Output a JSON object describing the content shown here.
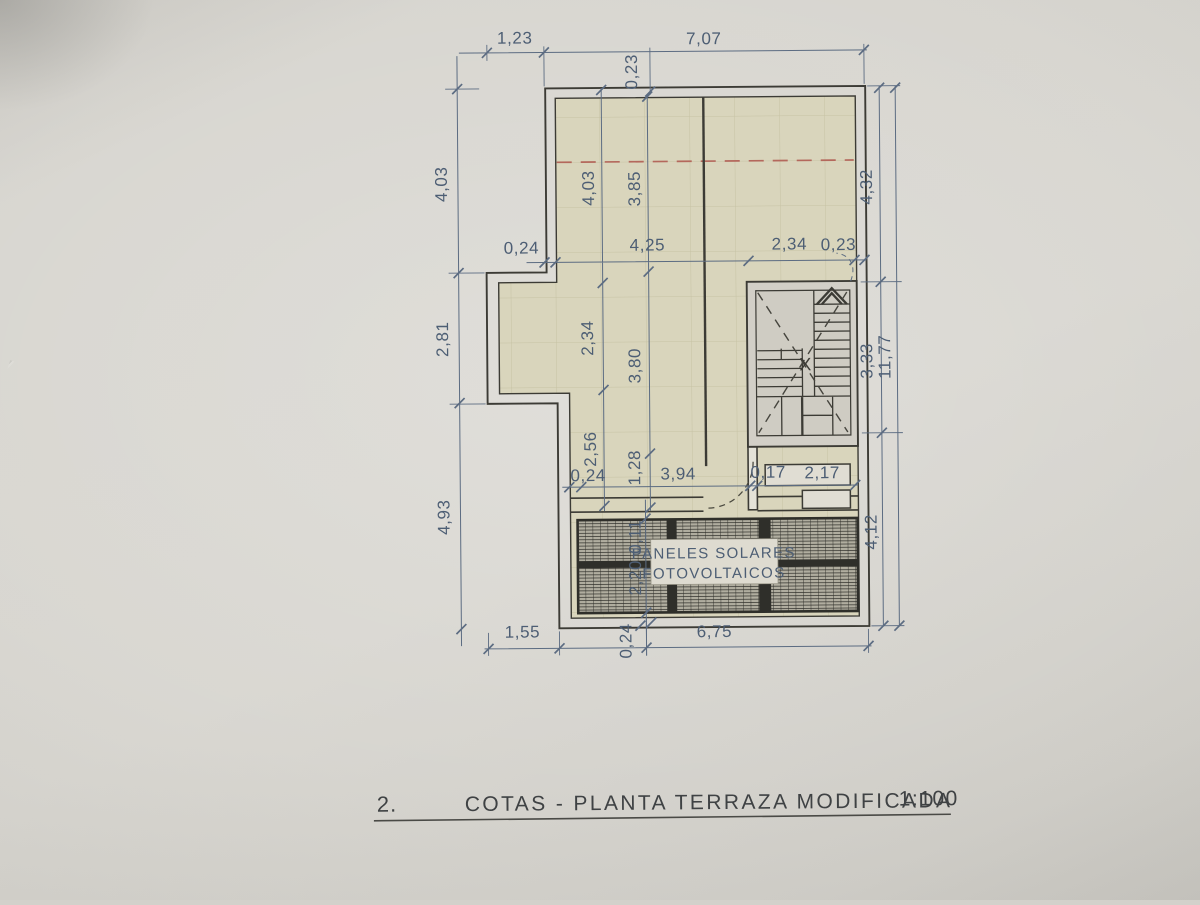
{
  "title": {
    "index": "2.",
    "label": "COTAS - PLANTA TERRAZA MODIFICADA",
    "scale": "1:100"
  },
  "plan": {
    "solar_label_line1": "PANELES SOLARES",
    "solar_label_line2": "FOTOVOLTAICOS",
    "stair_cross_mark": "X"
  },
  "dims": {
    "top_left": "1,23",
    "top_main": "7,07",
    "top_wall": "0,23",
    "left_upper": "4,03",
    "left_mid": "2,81",
    "left_lower": "4,93",
    "int_upper_a": "4,03",
    "int_upper_b": "3,85",
    "mid_wall": "0,24",
    "mid_span": "4,25",
    "mid_stair": "2,34",
    "mid_wall_right": "0,23",
    "int_mid_a": "2,34",
    "int_mid_b": "3,80",
    "int_low_a": "2,56",
    "int_low_b": "1,28",
    "low_wall": "0,24",
    "low_span": "3,94",
    "low_gap": "0,17",
    "low_right": "2,17",
    "right_upper": "4,32",
    "right_stair": "3,33",
    "right_total": "11,77",
    "right_lower": "4,12",
    "panel_gap": "0,11",
    "panel_height": "2,20",
    "bottom_left": "1,55",
    "bottom_wall": "0,24",
    "bottom_main": "6,75"
  },
  "colors": {
    "paper": "#d3d1cb",
    "floor": "#d9d5bc",
    "tile_line": "#c6c2a4",
    "wall": "#3c3b35",
    "dimension": "#5c6c82",
    "dimension_text": "#4d5e74",
    "red_dashed": "#b4685c",
    "panel_dark": "#2f2f2a",
    "panel_base": "#b0ad9f",
    "stair_fill": "#d2cfc7",
    "title_text": "#3f4244"
  }
}
